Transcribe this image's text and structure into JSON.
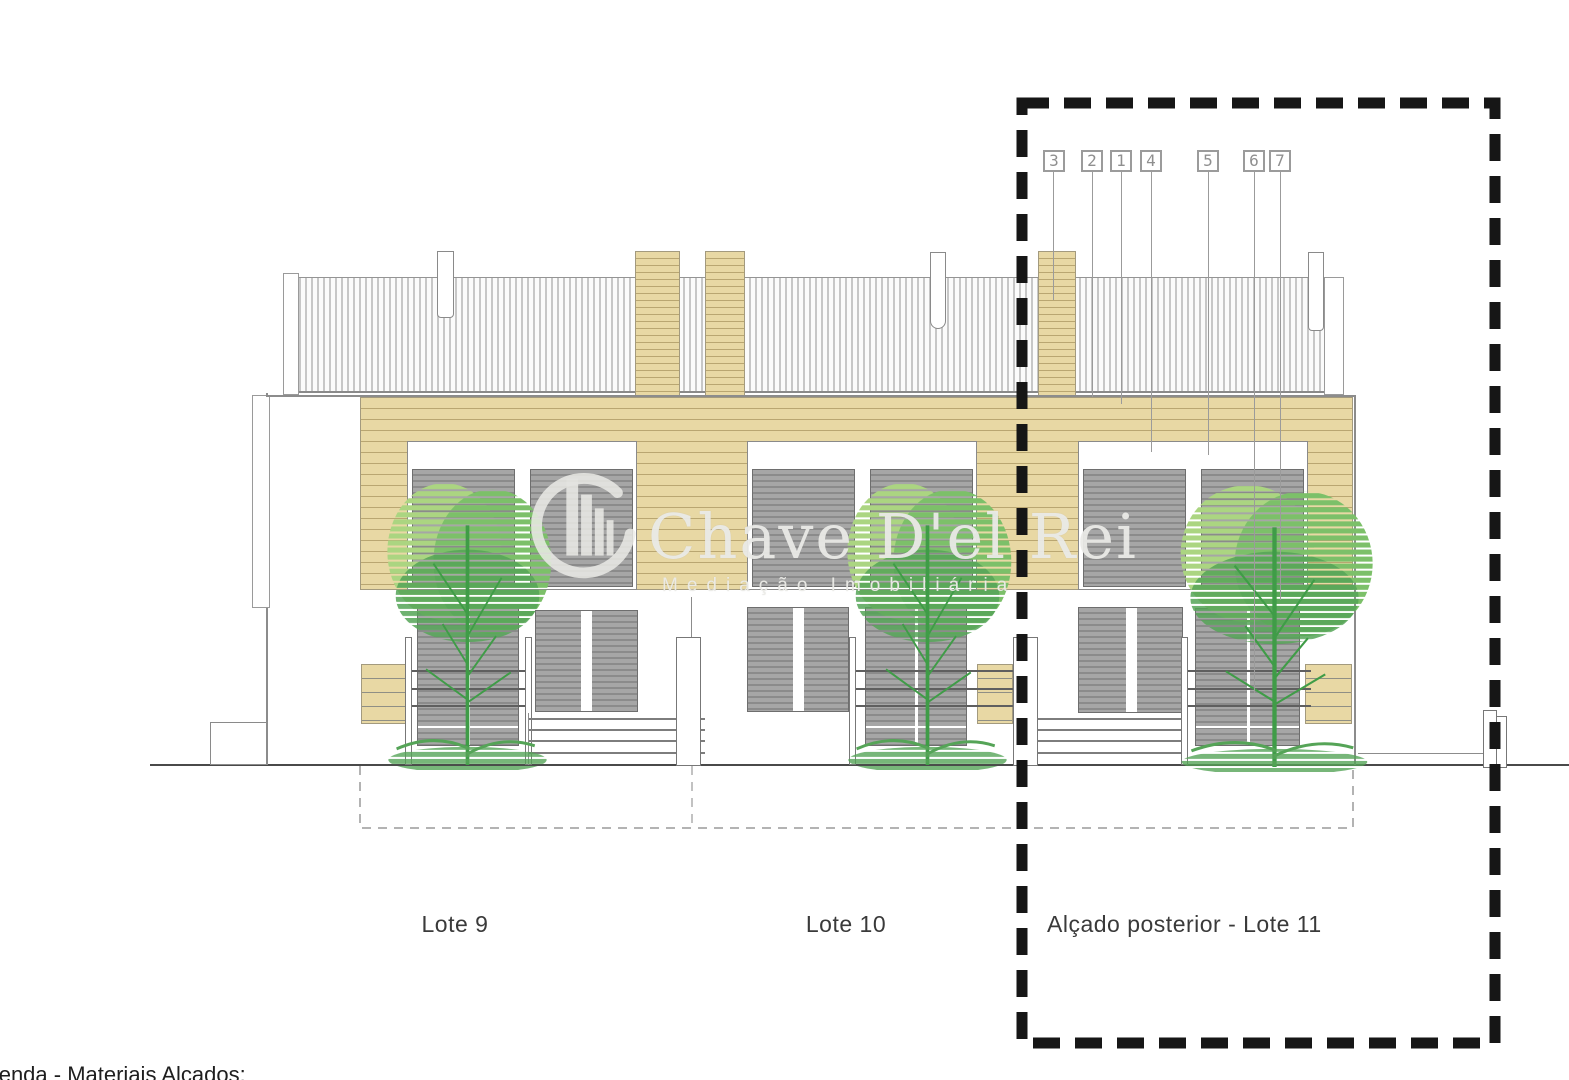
{
  "page": {
    "background": "#ffffff"
  },
  "drawing_labels": {
    "lote9": "Lote 9",
    "lote10": "Lote 10",
    "lote11": "Alçado posterior - Lote 11",
    "legend_caption": "Legenda - Materiais Alçados:"
  },
  "callouts": [
    {
      "label": "3"
    },
    {
      "label": "2"
    },
    {
      "label": "1"
    },
    {
      "label": "4"
    },
    {
      "label": "5"
    },
    {
      "label": "6"
    },
    {
      "label": "7"
    }
  ],
  "watermark": {
    "brand": "Chave D'el Rei",
    "subtitle": "Mediação Imobiliária",
    "logo_icon": "buildings-in-circle-icon"
  },
  "colors": {
    "facade_tan": "#e8d8a4",
    "facade_stripe": "#b9a671",
    "glazing_gray": "#a6a6a6",
    "glazing_gray_dark": "#8b8b8b",
    "tree_green_light": "#abd581",
    "tree_green_mid": "#7cc069",
    "tree_green_dark": "#55a457",
    "tree_trunk_green": "#3f9c47",
    "line_gray": "#8c8c8c",
    "highlight_dash_black": "#161616"
  }
}
